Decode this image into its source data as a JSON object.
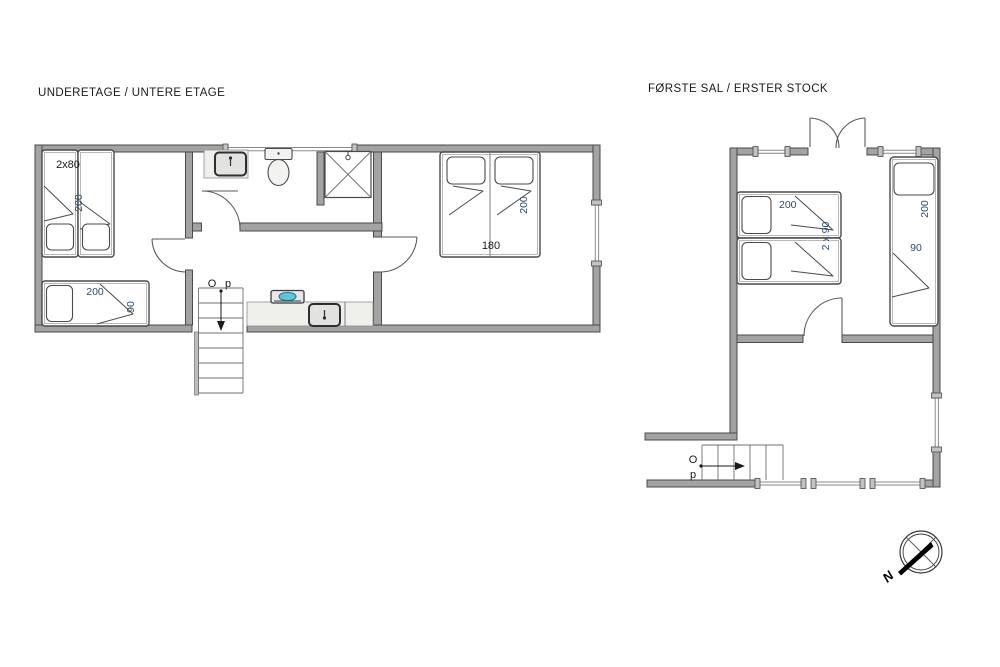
{
  "titles": {
    "ground_floor": "UNDERETAGE / UNTERE ETAGE",
    "first_floor": "FØRSTE SAL / ERSTER STOCK"
  },
  "ground_floor": {
    "twin_beds_width": "2x80",
    "twin_beds_length": "200",
    "single_bed_length": "200",
    "single_bed_width": "90",
    "double_bed_width": "180",
    "double_bed_length": "200",
    "stairs_label_o": "O",
    "stairs_label_p": "p"
  },
  "first_floor": {
    "twin_beds_length": "200",
    "twin_beds_width": "2 x 90",
    "single_bed_length": "200",
    "single_bed_width": "90",
    "stairs_label_o": "O",
    "stairs_label_p": "p"
  },
  "compass": {
    "north_label": "N"
  },
  "colors": {
    "wall_fill": "#a3a3a3",
    "wall_edge": "#4a4a4a",
    "dimension_label": "#2e4a6b",
    "text": "#1a1a1a",
    "hob_burner": "#5bc8d8"
  }
}
